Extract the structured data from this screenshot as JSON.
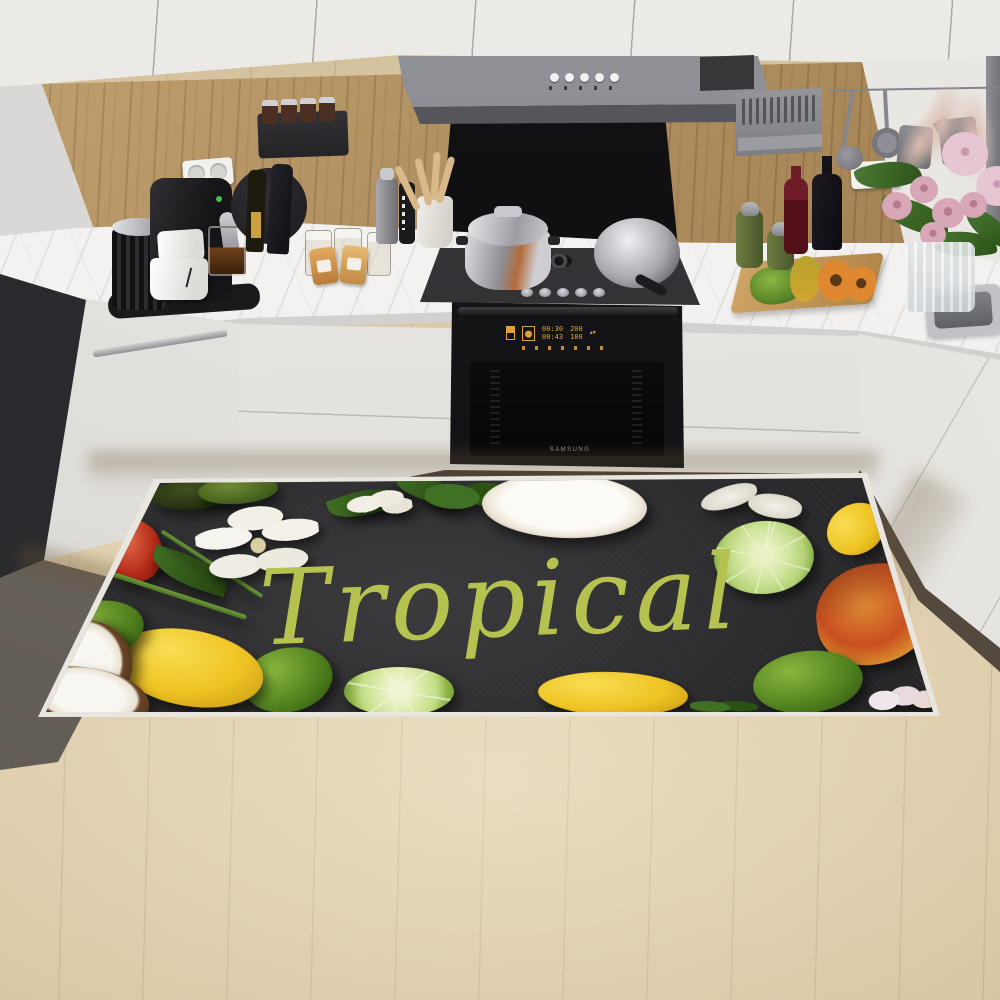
{
  "colors": {
    "amber": "#e0a13c",
    "mat-bg": "#2b2b2d",
    "mat-text": "#b5c24f",
    "floor": "#dcc9a7",
    "wood-wall": "#ab8a59",
    "cabinet-white": "#e5e2dc",
    "hood-gray": "#77777b",
    "marble": "#f3f2f0"
  },
  "mat": {
    "text": "Tropical",
    "text_color": "#b5c24f",
    "fruits": [
      {
        "type": "avocado-dark",
        "x": 150,
        "y": 477,
        "w": 95,
        "h": 32,
        "rot": -6
      },
      {
        "type": "avocado-green",
        "x": 198,
        "y": 476,
        "w": 80,
        "h": 28,
        "rot": -4
      },
      {
        "type": "red-fruit",
        "x": 110,
        "y": 520,
        "w": 52,
        "h": 62,
        "rot": -10
      },
      {
        "type": "leaf",
        "x": 150,
        "y": 556,
        "w": 80,
        "h": 30,
        "rot": 18
      },
      {
        "type": "stem",
        "x": 100,
        "y": 592,
        "w": 150,
        "h": 5,
        "rot": 18
      },
      {
        "type": "stem",
        "x": 152,
        "y": 562,
        "w": 120,
        "h": 4,
        "rot": 33
      },
      {
        "type": "flower",
        "x": 196,
        "y": 506,
        "w": 124,
        "h": 76,
        "rot": -6
      },
      {
        "type": "leaf",
        "x": 328,
        "y": 490,
        "w": 72,
        "h": 26,
        "rot": -18
      },
      {
        "type": "leaf",
        "x": 395,
        "y": 477,
        "w": 64,
        "h": 24,
        "rot": 10
      },
      {
        "type": "flower-small",
        "x": 346,
        "y": 486,
        "w": 66,
        "h": 36,
        "rot": -8
      },
      {
        "type": "greens",
        "x": 425,
        "y": 476,
        "w": 95,
        "h": 42,
        "rot": 4
      },
      {
        "type": "coconut-top",
        "x": 482,
        "y": 474,
        "w": 165,
        "h": 64,
        "rot": 2
      },
      {
        "type": "petal",
        "x": 700,
        "y": 486,
        "w": 58,
        "h": 22,
        "rot": -14
      },
      {
        "type": "petal",
        "x": 748,
        "y": 494,
        "w": 54,
        "h": 24,
        "rot": 12
      },
      {
        "type": "lime-cut",
        "x": 714,
        "y": 521,
        "w": 100,
        "h": 73,
        "rot": -4
      },
      {
        "type": "lemon",
        "x": 826,
        "y": 504,
        "w": 60,
        "h": 50,
        "rot": -28
      },
      {
        "type": "mango",
        "x": 816,
        "y": 564,
        "w": 118,
        "h": 100,
        "rot": -8
      },
      {
        "type": "lime",
        "x": 753,
        "y": 651,
        "w": 110,
        "h": 62,
        "rot": -6
      },
      {
        "type": "orchid",
        "x": 868,
        "y": 684,
        "w": 72,
        "h": 30,
        "rot": -4
      },
      {
        "type": "lemon",
        "x": 538,
        "y": 672,
        "w": 150,
        "h": 44,
        "rot": 2
      },
      {
        "type": "lime-slice",
        "x": 344,
        "y": 667,
        "w": 110,
        "h": 49,
        "rot": 0
      },
      {
        "type": "lime",
        "x": 243,
        "y": 648,
        "w": 90,
        "h": 64,
        "rot": -12
      },
      {
        "type": "lemon",
        "x": 114,
        "y": 630,
        "w": 150,
        "h": 76,
        "rot": 10
      },
      {
        "type": "lime",
        "x": 52,
        "y": 601,
        "w": 92,
        "h": 56,
        "rot": -8
      },
      {
        "type": "coconut-side",
        "x": 42,
        "y": 620,
        "w": 90,
        "h": 88,
        "rot": -24
      },
      {
        "type": "coconut-side",
        "x": 28,
        "y": 668,
        "w": 122,
        "h": 60,
        "rot": 8
      },
      {
        "type": "greens",
        "x": 690,
        "y": 698,
        "w": 70,
        "h": 18,
        "rot": 3
      }
    ]
  },
  "oven": {
    "brand": "SAMSUNG",
    "display": {
      "time_top": "00:30",
      "time_bottom": "00:43",
      "temp_top": "200",
      "temp_bottom": "180",
      "arrows": "▴▾"
    }
  },
  "counter_items": [
    "coffee-machine",
    "milk-frother",
    "coffee-mugs",
    "glass-coffee-cup",
    "wall-outlets",
    "spice-shelf",
    "spice-jars",
    "wine-bottles",
    "round-serving-board",
    "storage-jars",
    "snack-packs",
    "utensil-crock",
    "wooden-utensils",
    "pressure-cooker",
    "saute-pan",
    "gas-hob",
    "range-hood",
    "cutting-board",
    "papaya",
    "papaya-slices",
    "oil-bottles",
    "wine-carafe",
    "wine-bottle",
    "flower-vase",
    "rose-bouquet",
    "pampas-grass",
    "hanging-utensils",
    "kitchen-sink",
    "built-in-oven",
    "dishwasher"
  ]
}
